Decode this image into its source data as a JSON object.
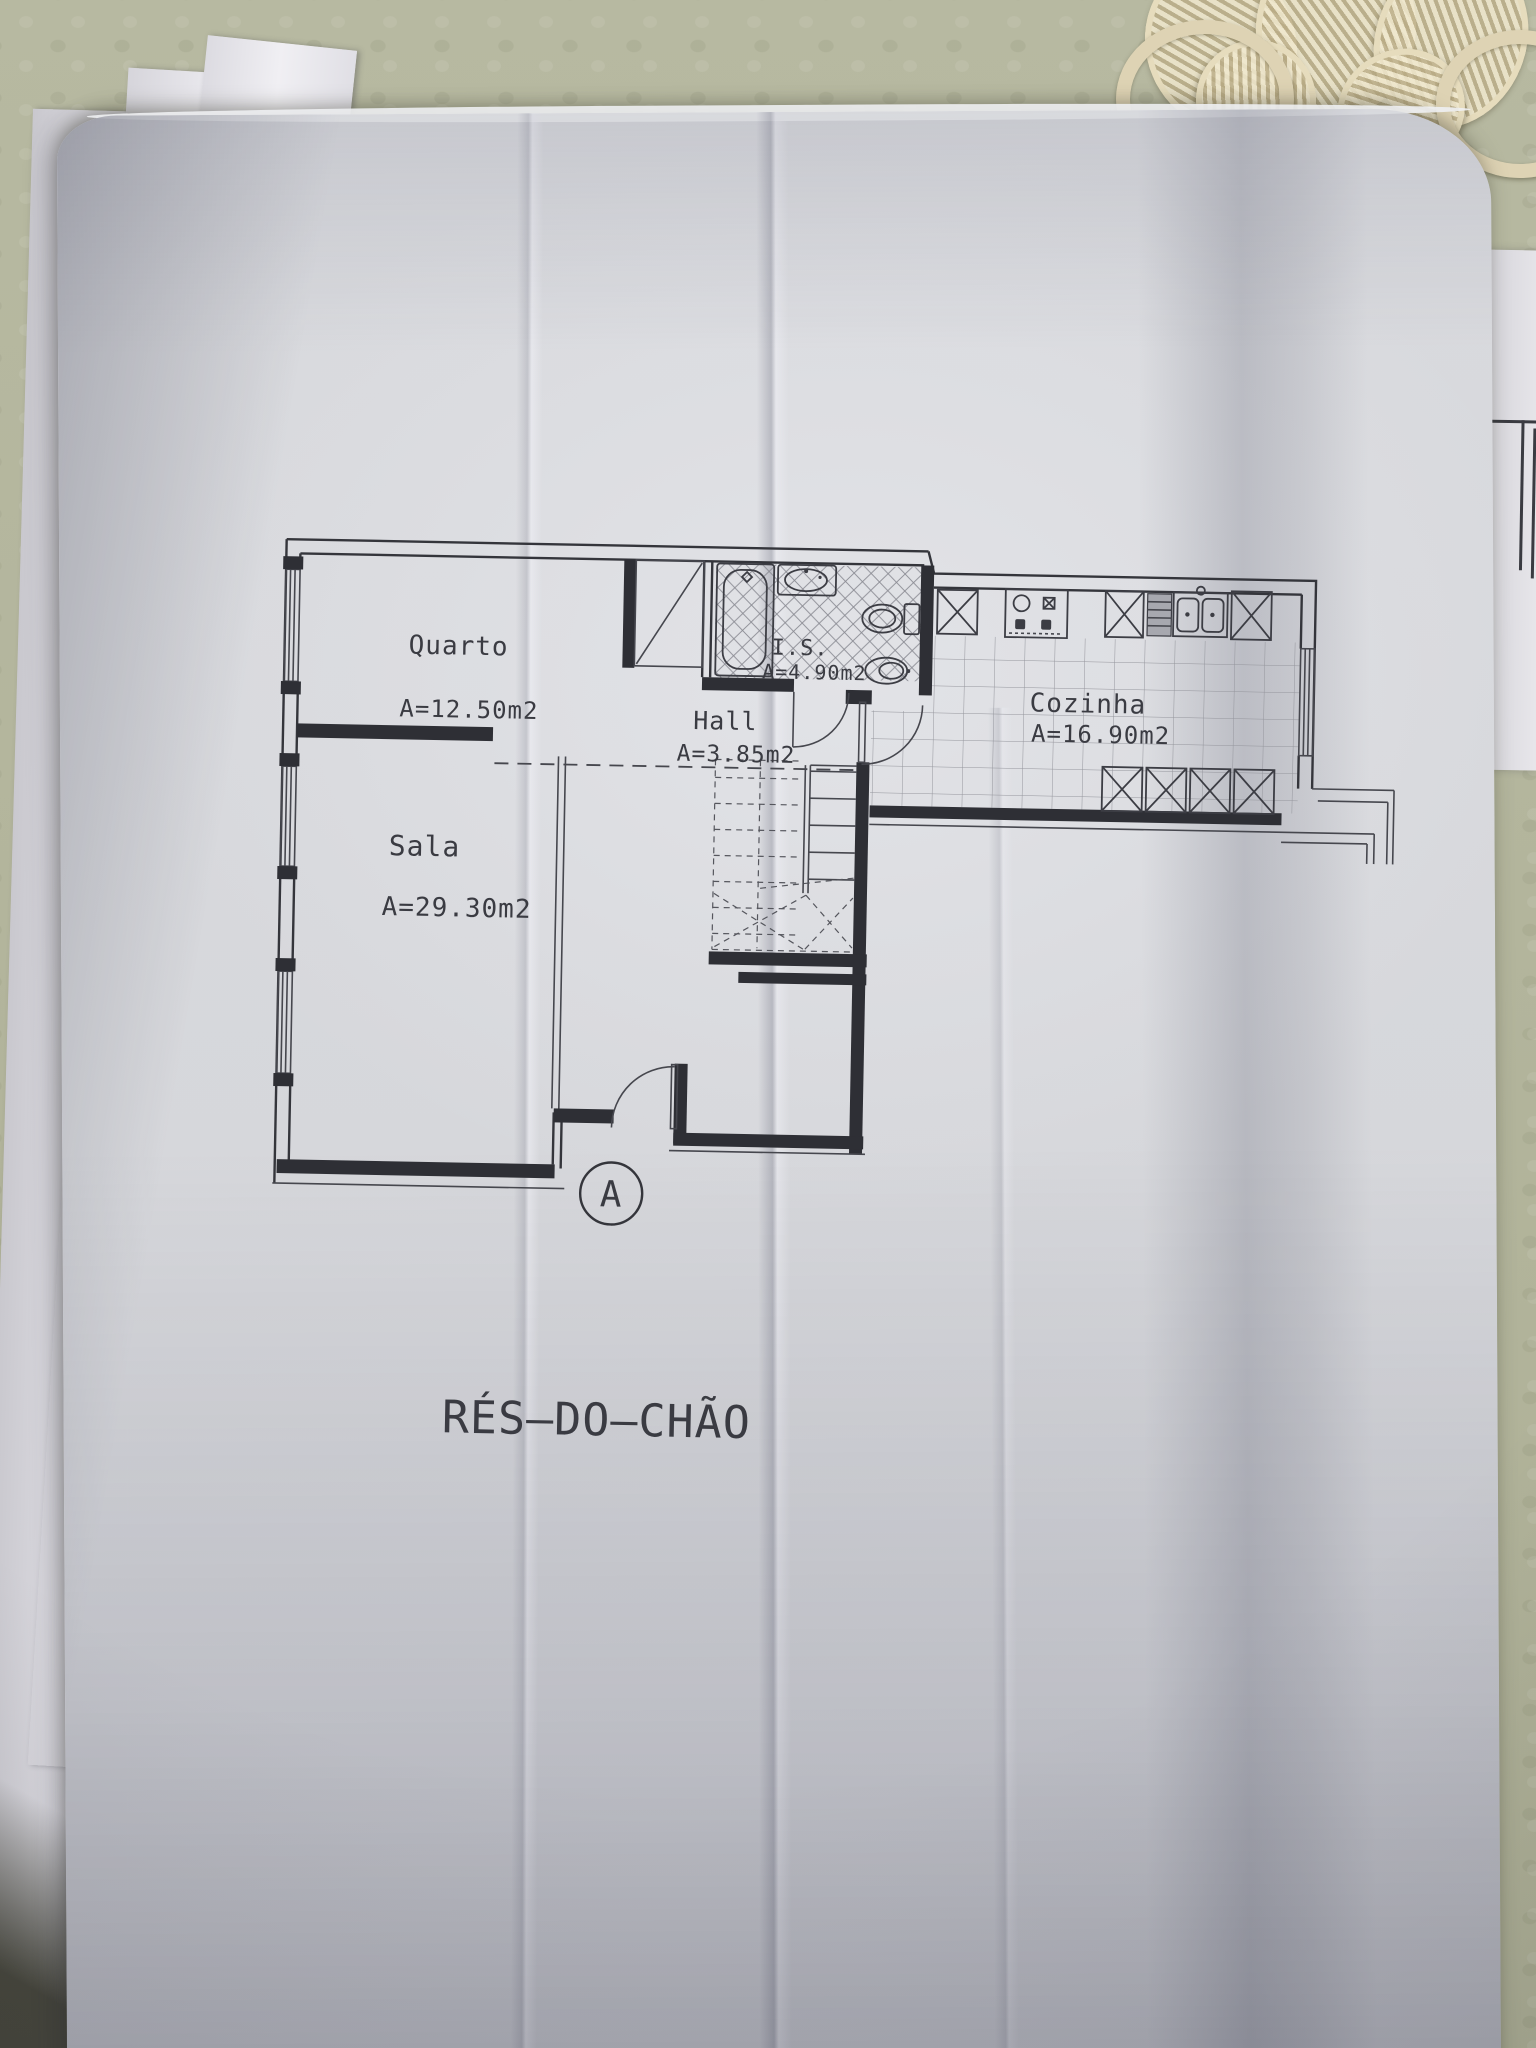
{
  "floor_plan": {
    "title": "RÉS—DO—CHÃO",
    "section_marker": "A",
    "rooms": [
      {
        "name": "Quarto",
        "area": "A=12.50m2"
      },
      {
        "name": "Sala",
        "area": "A=29.30m2"
      },
      {
        "name": "Hall",
        "area": "A=3.85m2"
      },
      {
        "name": "I.S.",
        "area": "A=4.90m2"
      },
      {
        "name": "Cozinha",
        "area": "A=16.90m2"
      }
    ]
  },
  "colors": {
    "ink": "#34353b",
    "paper": "#d9dade",
    "tablecloth": "#b2b49b",
    "lace": "#ddd3b6",
    "left_pages": "#e7e6ea"
  }
}
